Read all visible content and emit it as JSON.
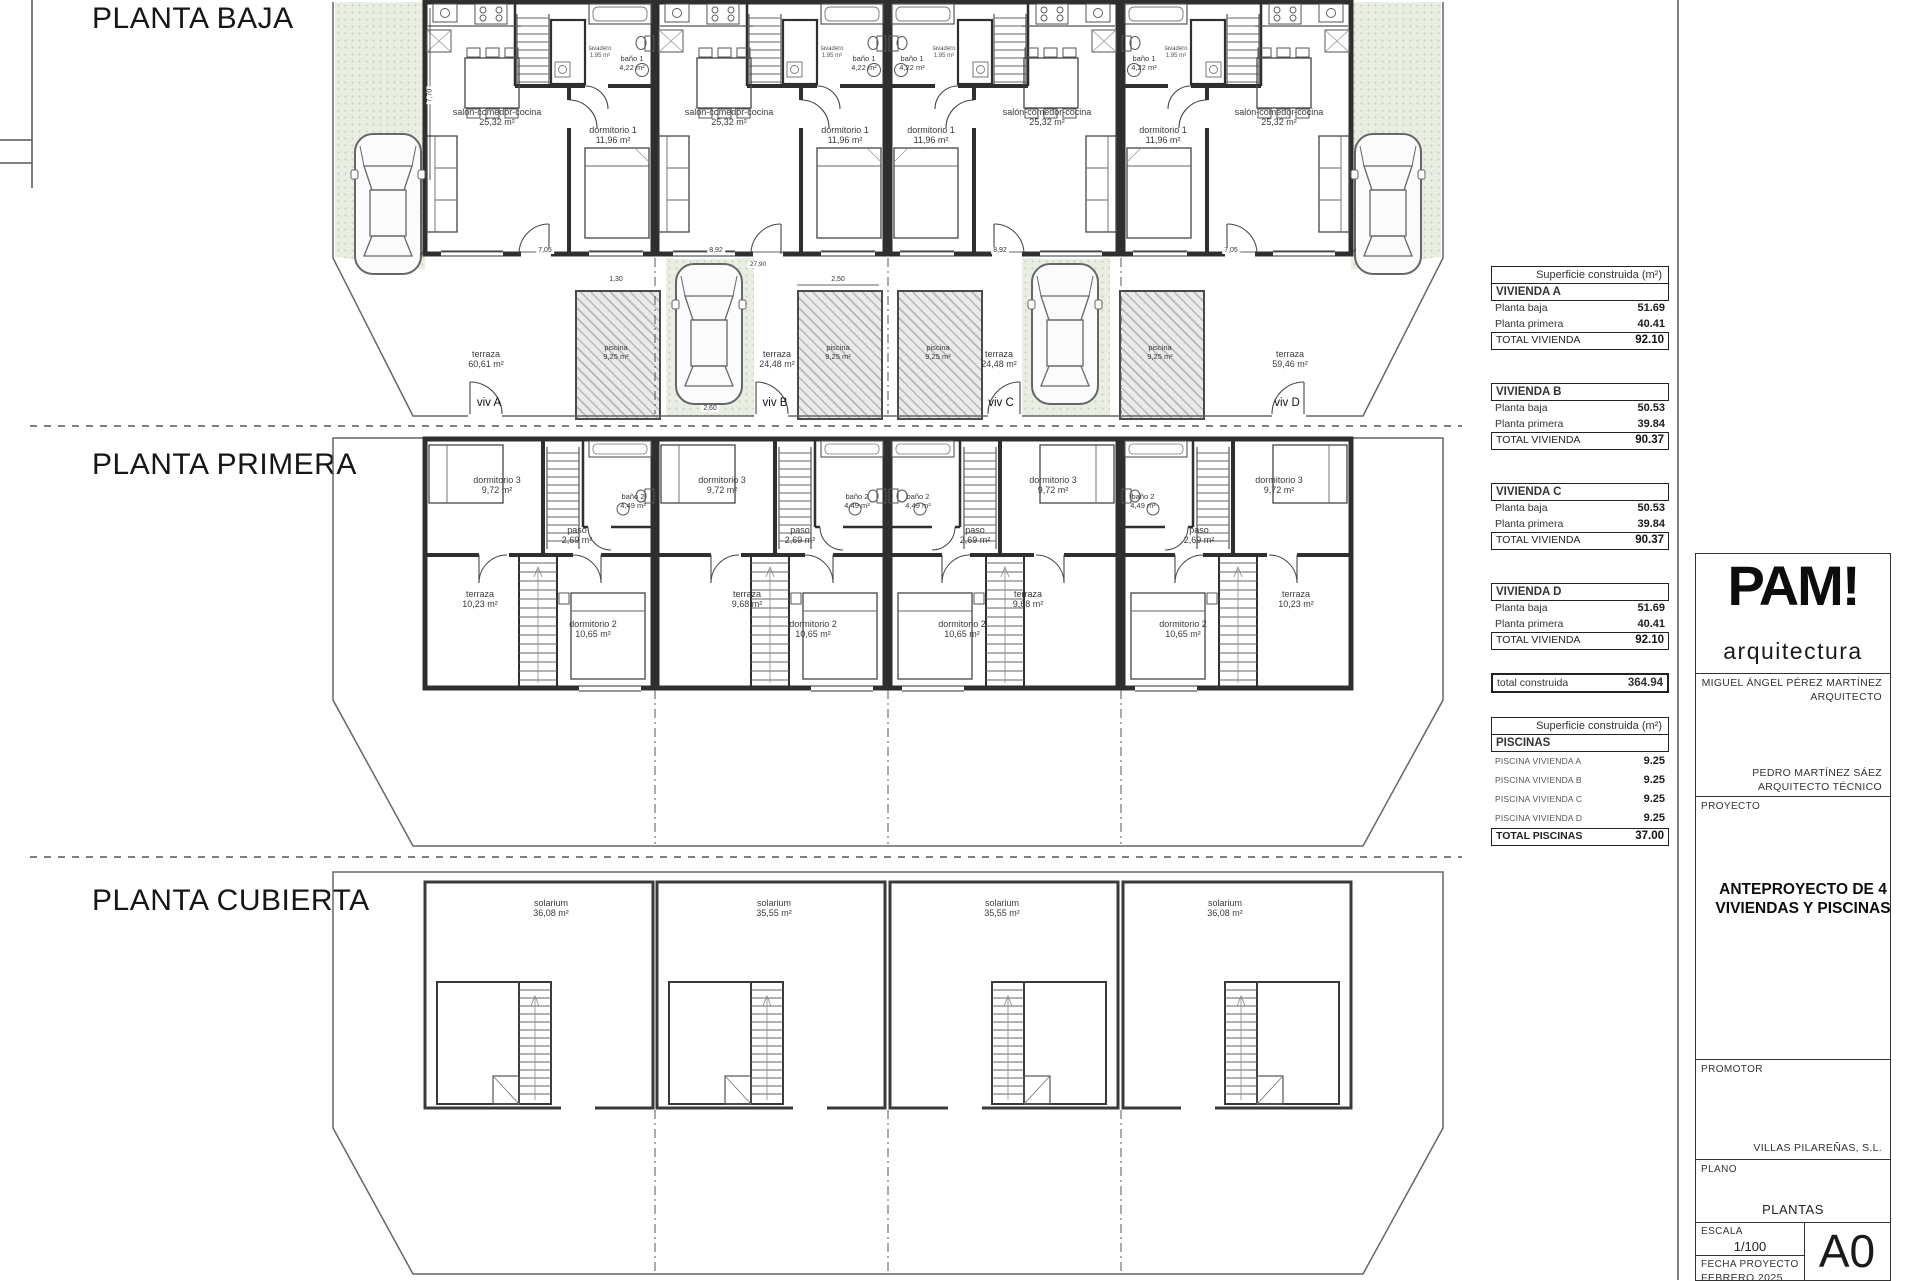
{
  "plans": {
    "baja": {
      "title": "PLANTA BAJA",
      "salon_name": "salón-comedor-cocina",
      "salon_area": "25,32 m²",
      "dorm1_name": "dormitorio 1",
      "dorm1_area": "11,96 m²",
      "bano1_name": "baño 1",
      "bano1_area": "4,22 m²",
      "lavadero_name": "lavadero",
      "lavadero_area": "1,95 m²",
      "piscina_name": "piscina",
      "piscina_area": "9,25 m²",
      "terraza_name": "terraza",
      "terraza_areas": [
        "60,61 m²",
        "24,48 m²",
        "24,48 m²",
        "59,46 m²"
      ],
      "viv_labels": [
        "viv A",
        "viv B",
        "viv C",
        "viv D"
      ],
      "dims": [
        "7,05",
        "8,92",
        "27,90",
        "8,92",
        "7,05"
      ],
      "dim_250": "2,50",
      "dim_260": "2,60",
      "dim_130": "1,30",
      "dim_770": "7,70"
    },
    "primera": {
      "title": "PLANTA PRIMERA",
      "dorm3_name": "dormitorio 3",
      "dorm3_area": "9,72 m²",
      "bano2_name": "baño 2",
      "bano2_area": "4,49 m²",
      "paso_name": "paso",
      "paso_area": "2,69 m²",
      "terraza_name": "terraza",
      "terraza_areas": [
        "10,23 m²",
        "9,68 m²",
        "9,68 m²",
        "10,23 m²"
      ],
      "dorm2_name": "dormitorio 2",
      "dorm2_area": "10,65 m²"
    },
    "cubierta": {
      "title": "PLANTA CUBIERTA",
      "solarium_name": "solarium",
      "solarium_areas": [
        "36,08 m²",
        "35,55 m²",
        "35,55 m²",
        "36,08 m²"
      ]
    }
  },
  "tables": {
    "construida": {
      "header": "Superficie construida (m²)",
      "blocks": [
        {
          "name": "VIVIENDA A",
          "rows": [
            {
              "label": "Planta baja",
              "value": "51.69"
            },
            {
              "label": "Planta primera",
              "value": "40.41"
            }
          ],
          "total_label": "TOTAL VIVIENDA",
          "total_value": "92.10"
        },
        {
          "name": "VIVIENDA B",
          "rows": [
            {
              "label": "Planta baja",
              "value": "50.53"
            },
            {
              "label": "Planta primera",
              "value": "39.84"
            }
          ],
          "total_label": "TOTAL VIVIENDA",
          "total_value": "90.37"
        },
        {
          "name": "VIVIENDA C",
          "rows": [
            {
              "label": "Planta baja",
              "value": "50.53"
            },
            {
              "label": "Planta primera",
              "value": "39.84"
            }
          ],
          "total_label": "TOTAL VIVIENDA",
          "total_value": "90.37"
        },
        {
          "name": "VIVIENDA D",
          "rows": [
            {
              "label": "Planta baja",
              "value": "51.69"
            },
            {
              "label": "Planta primera",
              "value": "40.41"
            }
          ],
          "total_label": "TOTAL VIVIENDA",
          "total_value": "92.10"
        }
      ],
      "grand_label": "total construida",
      "grand_value": "364.94"
    },
    "piscinas": {
      "header": "Superficie construida (m²)",
      "name": "PISCINAS",
      "rows": [
        {
          "label": "PISCINA VIVIENDA A",
          "value": "9.25"
        },
        {
          "label": "PISCINA VIVIENDA B",
          "value": "9.25"
        },
        {
          "label": "PISCINA VIVIENDA C",
          "value": "9.25"
        },
        {
          "label": "PISCINA VIVIENDA D",
          "value": "9.25"
        }
      ],
      "total_label": "TOTAL PISCINAS",
      "total_value": "37.00"
    }
  },
  "titleblock": {
    "logo": "PAM!",
    "logo_sub": "arquitectura",
    "architect_name": "MIGUEL ÁNGEL PÉREZ MARTÍNEZ",
    "architect_role": "ARQUITECTO",
    "tech_name": "PEDRO MARTÍNEZ SÁEZ",
    "tech_role": "ARQUITECTO TÉCNICO",
    "proyecto_label": "PROYECTO",
    "proyecto_title": "ANTEPROYECTO DE 4 VIVIENDAS Y PISCINAS",
    "promotor_label": "PROMOTOR",
    "promotor_name": "VILLAS PILAREÑAS, S.L.",
    "plano_label": "PLANO",
    "plano_name": "PLANTAS",
    "escala_label": "ESCALA",
    "escala_value": "1/100",
    "fecha_label": "FECHA PROYECTO",
    "fecha_value": "FEBRERO 2025",
    "sheet_size": "A0"
  }
}
